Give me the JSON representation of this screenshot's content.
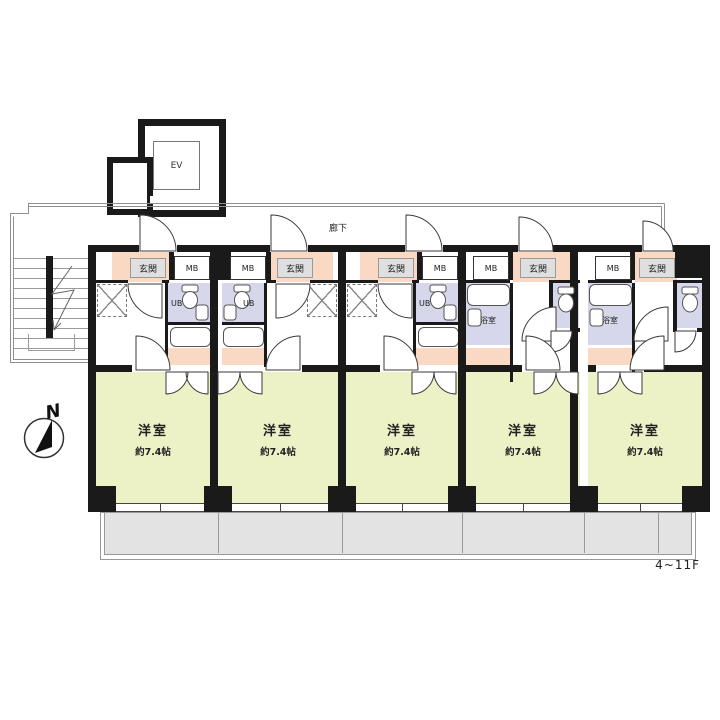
{
  "plan": {
    "floor_label": "4~11F",
    "corridor_label": "廊下",
    "elevator_label": "EV",
    "compass_label": "N",
    "colors": {
      "wall": "#1a1a1a",
      "room_floor": "#edf2c6",
      "wet_area": "#d6d7ea",
      "entrance_tile": "#f9d8c4",
      "balcony": "#e3e3e3",
      "label_box": "#dfdfdf"
    },
    "units": [
      {
        "room_label": "洋室",
        "size_label": "約7.4帖",
        "entrance_label": "玄関",
        "meter_box_label": "MB",
        "bath_label": "UB"
      },
      {
        "room_label": "洋室",
        "size_label": "約7.4帖",
        "entrance_label": "玄関",
        "meter_box_label": "MB",
        "bath_label": "UB"
      },
      {
        "room_label": "洋室",
        "size_label": "約7.4帖",
        "entrance_label": "玄関",
        "meter_box_label": "MB",
        "bath_label": "UB"
      },
      {
        "room_label": "洋室",
        "size_label": "約7.4帖",
        "entrance_label": "玄関",
        "meter_box_label": "MB",
        "bath_label": "浴室"
      },
      {
        "room_label": "洋室",
        "size_label": "約7.4帖",
        "entrance_label": "玄関",
        "meter_box_label": "MB",
        "bath_label": "浴室"
      }
    ]
  }
}
